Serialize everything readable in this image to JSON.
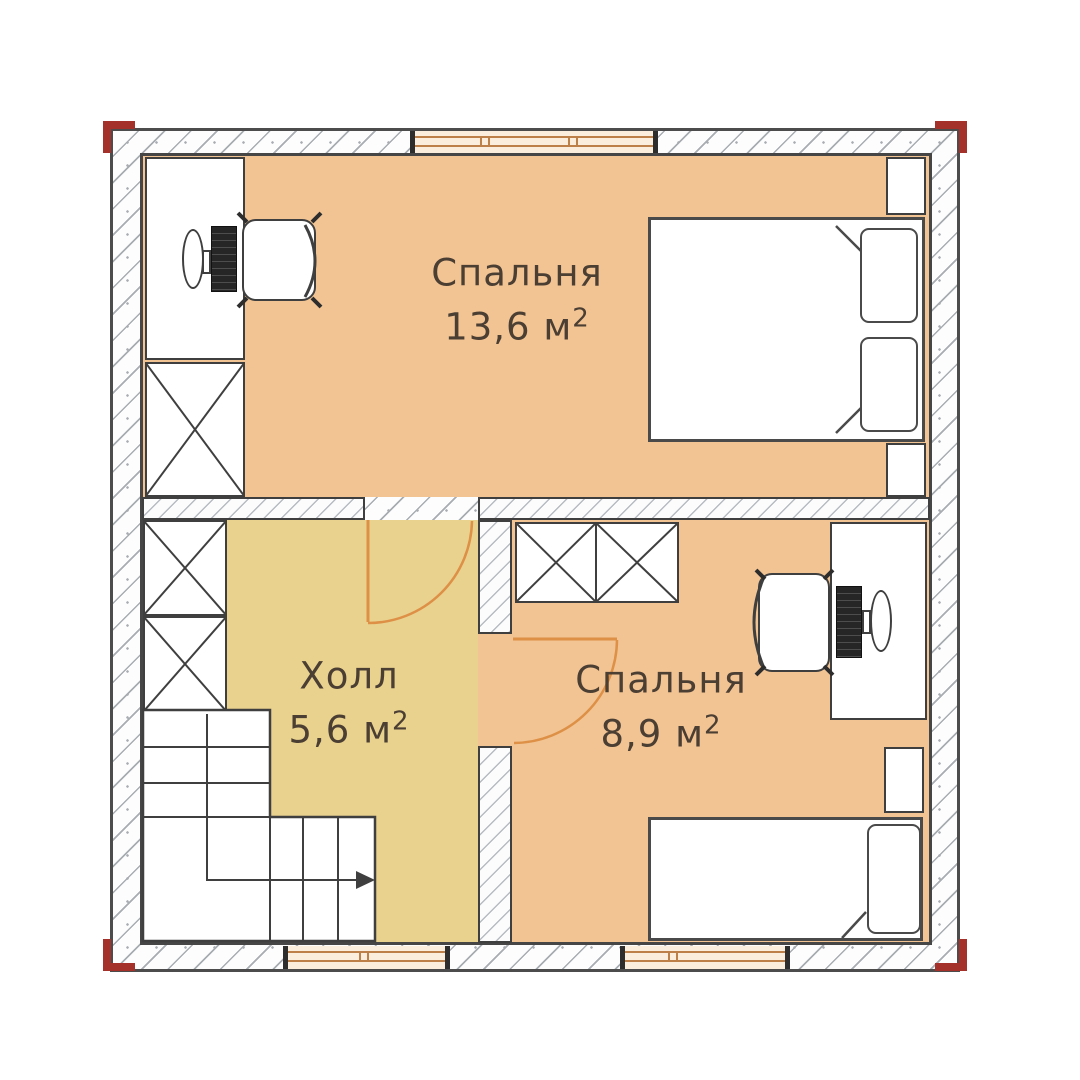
{
  "plan": {
    "type": "floor-plan",
    "rooms": [
      {
        "id": "bedroom-1",
        "name": "Спальня",
        "area": "13,6 м",
        "area_sup": "2",
        "furniture": [
          "desk",
          "office-chair",
          "wardrobe",
          "double-bed",
          "nightstand",
          "nightstand"
        ]
      },
      {
        "id": "hall",
        "name": "Холл",
        "area": "5,6 м",
        "area_sup": "2",
        "furniture": [
          "wardrobe",
          "wardrobe",
          "staircase"
        ]
      },
      {
        "id": "bedroom-2",
        "name": "Спальня",
        "area": "8,9 м",
        "area_sup": "2",
        "furniture": [
          "wardrobe",
          "wardrobe",
          "desk",
          "office-chair",
          "nightstand",
          "single-bed"
        ]
      }
    ],
    "features": {
      "windows": 3,
      "doors": 2,
      "corner_markers": 4,
      "stair_direction": "right-arrow"
    },
    "colors": {
      "bedroom_floor": "#f2c493",
      "hall_floor": "#e9d28e",
      "wall_hatch": "#a8adb2",
      "door_accent": "#dd9046",
      "window_frame": "#bd8049",
      "corner_marker": "#a5322a",
      "label_text": "#4b3e33"
    }
  }
}
